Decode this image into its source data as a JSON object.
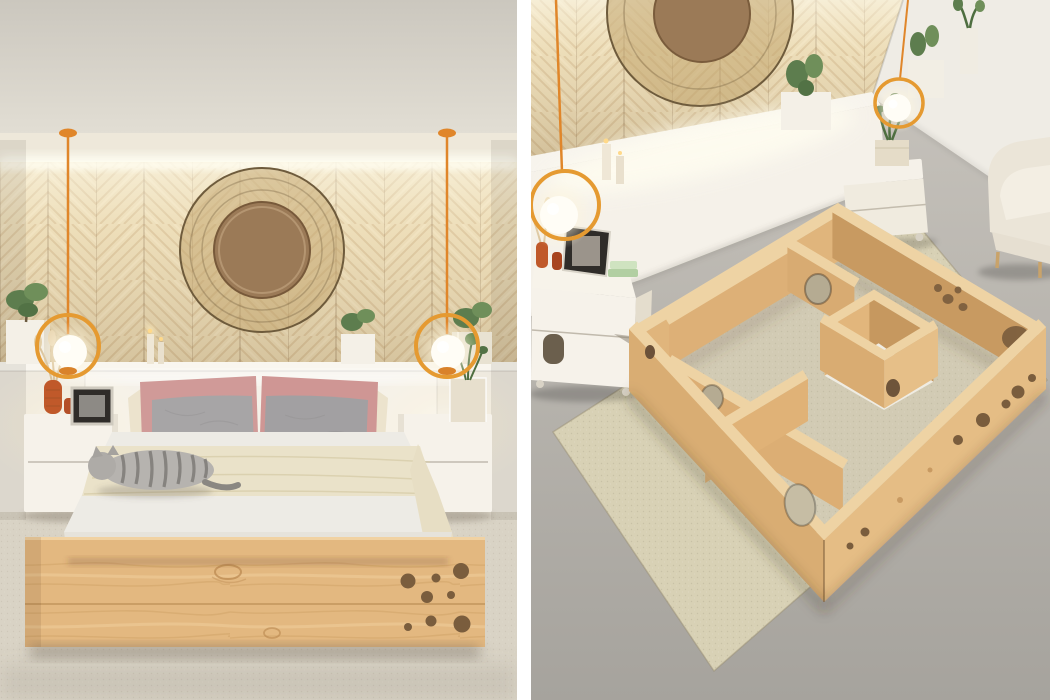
{
  "title": "Cat maze bed concept - two-panel interior render collage",
  "canvas": {
    "width": 1050,
    "height": 700
  },
  "divider_color": "#ffffff",
  "colors": {
    "background": "#ffffff",
    "ceiling_top": "#cbc7be",
    "ceiling_bottom": "#e2ded4",
    "soffit": "#eee8da",
    "cove_light": "#fffef4",
    "wood_wall_base": "#ead9b2",
    "wood_wall_grain": "#cdb185",
    "decor_ring": "#c1a46c",
    "decor_ring_edge": "#6e5b3c",
    "decor_disc": "#9b7a57",
    "pendant_orange": "#e59a31",
    "pendant_cord": "#e0862a",
    "lamp_globe": "#fffdf6",
    "headboard_white": "#f5f1e9",
    "wall_white": "#eee9df",
    "side_wall_white": "#efece5",
    "nightstand_white": "#f6f2ea",
    "mattress": "#edebe5",
    "mattress_front": "#e6e3db",
    "blanket": "#eae2c9",
    "pillow_grey": "#a7a5a6",
    "pillow_pink": "#d09a98",
    "pillow_cream": "#ece3cd",
    "cat_grey": "#b6b3af",
    "cat_stripe": "#76736f",
    "bed_wood": "#e3b880",
    "bed_wood_seam": "#c89c63",
    "hole_dark": "#7a5d3d",
    "carpet": "#d9d3c5",
    "floor_grey_top": "#cac6bf",
    "floor_grey_bottom": "#a6a39d",
    "rug": "#d8d1b5",
    "maze_wood_top": "#eed3a4",
    "maze_wood_light": "#e5bd85",
    "maze_wood_mid": "#dcae74",
    "maze_wood_shadow": "#c89a61",
    "armchair": "#ebe5d8",
    "plant_green": "#5d7d4e",
    "plant_green_dark": "#4e6e40",
    "planter_white": "#f4f0e7",
    "vase_orange": "#c0592a",
    "frame_dark": "#2f2c29"
  },
  "panels": {
    "left": {
      "name": "bedroom-front-view",
      "objects": [
        "chevron-wood-wall",
        "cove-light",
        "round-rattan-wall-decor",
        "pendant-lamp-left",
        "pendant-lamp-right",
        "headboard-ledge",
        "ledge-plants",
        "candles",
        "nightstand-left",
        "nightstand-right",
        "picture-frame",
        "orange-vase",
        "glass-planter",
        "bed",
        "pink-pillows",
        "grey-pillows",
        "cream-blanket",
        "sleeping-cat",
        "pine-bed-frame",
        "cat-holes",
        "beige-carpet"
      ]
    },
    "right": {
      "name": "bedroom-aerial-maze-view",
      "objects": [
        "chevron-wood-wall",
        "round-rattan-wall-decor",
        "headboard-ledge",
        "cactus-planters",
        "candles",
        "pendant-lamp-left",
        "pendant-lamp-right",
        "nightstand-with-litter-door",
        "picture-frame",
        "orange-vases",
        "rolling-nightstand",
        "travertine-planter",
        "white-armchair",
        "cat-maze-bed-frame",
        "maze-inner-walls",
        "maze-central-box",
        "cat-holes",
        "area-rug",
        "concrete-floor"
      ]
    }
  }
}
